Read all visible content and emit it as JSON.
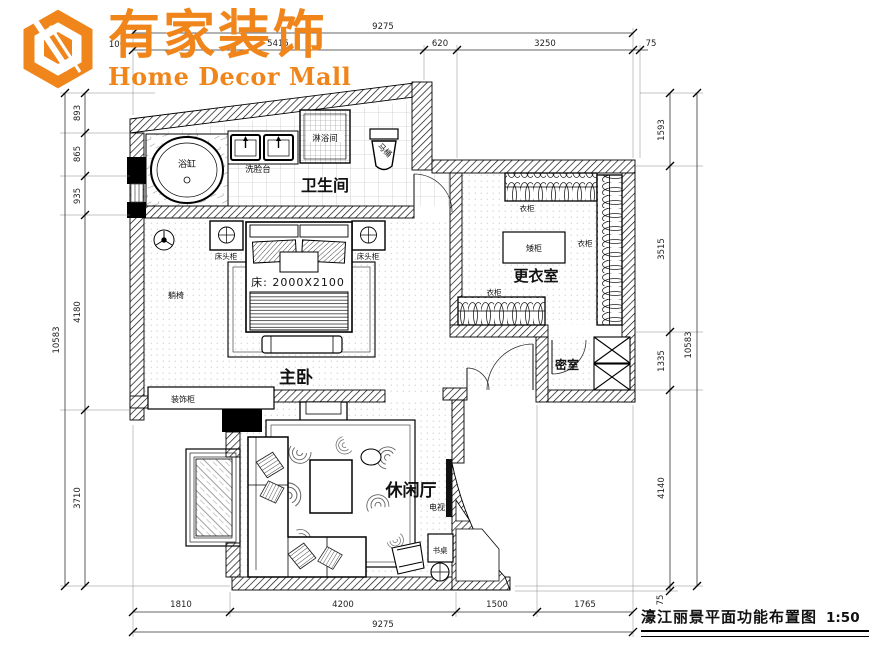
{
  "brand": {
    "name_cn": "有家装饰",
    "name_en": "Home Decor Mall"
  },
  "drawing_title": {
    "name": "濠江丽景平面功能布置图",
    "scale": "1:50"
  },
  "rooms": {
    "bathroom": "卫生间",
    "master_bedroom": "主卧",
    "dressing_room": "更衣室",
    "secret_room": "密室",
    "leisure_hall": "休闲厅"
  },
  "labels": {
    "bathtub": "浴缸",
    "washstand": "洗脸台",
    "shower_room": "淋浴间",
    "toilet": "马桶",
    "bedside_cabinet_left": "床头柜",
    "bedside_cabinet_right": "床头柜",
    "bed_size": "床: 2000X2100",
    "lounge_chair": "躺椅",
    "decor_cabinet": "装饰柜",
    "wardrobe_top": "衣柜",
    "wardrobe_right": "衣柜",
    "wardrobe_bottom": "衣柜",
    "low_cabinet": "矮柜",
    "tv": "电视",
    "desk": "书桌"
  },
  "dimensions": {
    "top_overall": "9275",
    "top_row": [
      "100",
      "5415",
      "620",
      "3250",
      "75"
    ],
    "bottom_overall": "9275",
    "bottom_row": [
      "1810",
      "4200",
      "1500",
      "1765"
    ],
    "left_overall": "10583",
    "left_row": [
      "893",
      "865",
      "935",
      "4180",
      "3710"
    ],
    "right_overall": "10583",
    "right_row": [
      "1593",
      "3515",
      "1335",
      "4140",
      "75"
    ]
  },
  "colors": {
    "brand_orange": "#F0861B",
    "wall_black": "#111111"
  }
}
